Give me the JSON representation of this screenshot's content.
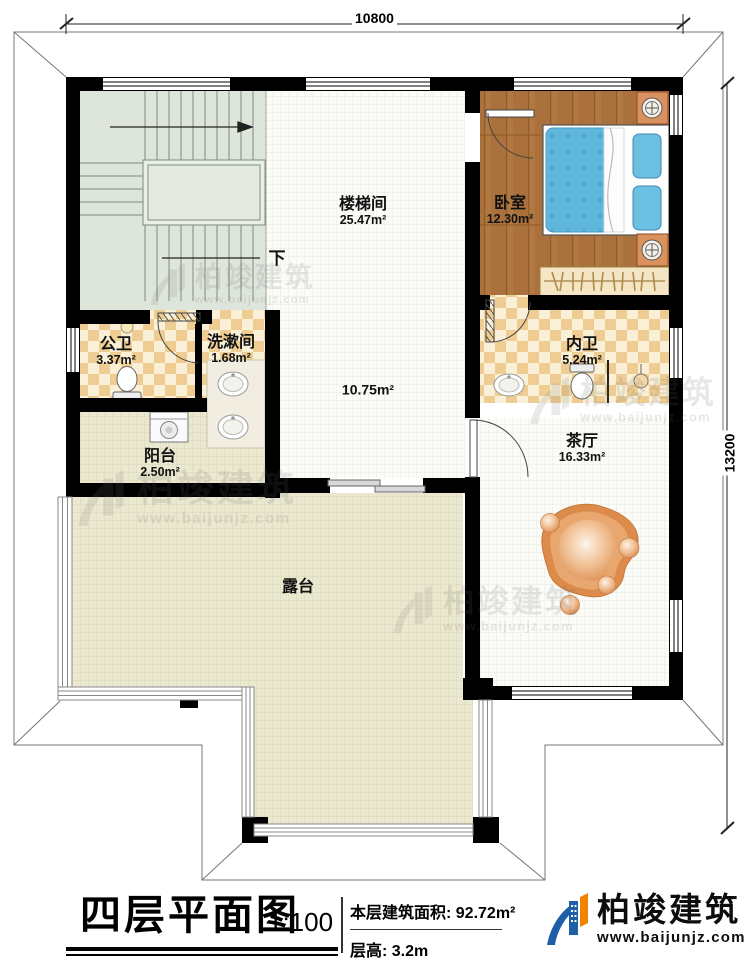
{
  "plan": {
    "dim_top": "10800",
    "dim_right": "13200",
    "stairs_note": "下",
    "rooms": {
      "staircase": {
        "name": "楼梯间",
        "area": "25.47m²"
      },
      "bedroom": {
        "name": "卧室",
        "area": "12.30m²"
      },
      "public_bath": {
        "name": "公卫",
        "area": "3.37m²"
      },
      "washroom": {
        "name": "洗漱间",
        "area": "1.68m²"
      },
      "inner_bath": {
        "name": "内卫",
        "area": "5.24m²"
      },
      "balcony": {
        "name": "阳台",
        "area": "2.50m²"
      },
      "tea_hall": {
        "name": "茶厅",
        "area": "16.33m²"
      },
      "hallway": {
        "area": "10.75m²"
      },
      "terrace": {
        "name": "露台"
      }
    }
  },
  "title_block": {
    "title": "四层平面图",
    "scale": "1:100",
    "area_info": "本层建筑面积: 92.72m²",
    "height_info": "层高: 3.2m"
  },
  "branding": {
    "company": "柏竣建筑",
    "website": "www.baijunjz.com"
  },
  "colors": {
    "wall": "#000000",
    "wood_floor": "#aa713c",
    "bed_blue": "#5fb7dc",
    "checker_tan": "#efcd92",
    "terrace_beige": "#ebe8d0",
    "stair_green": "#dee5da",
    "rug_orange": "#dc8b4a",
    "logo_blue": "#1e5fa8",
    "logo_orange": "#f08300"
  }
}
